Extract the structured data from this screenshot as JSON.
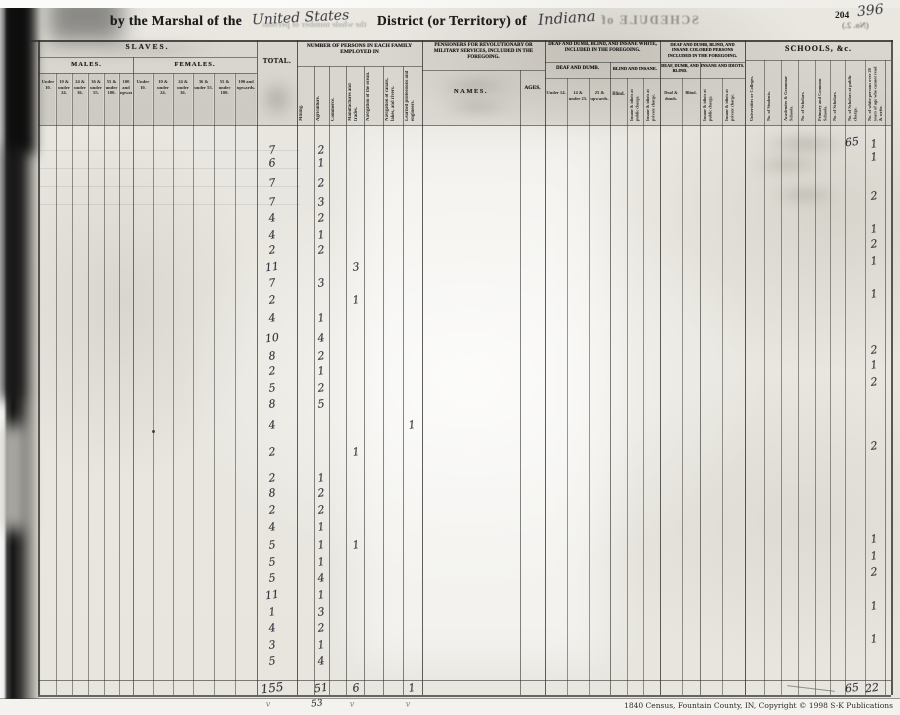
{
  "header": {
    "prefix": "by the Marshal of the",
    "written_jurisdiction": "United States",
    "district_label": "District (or Territory) of",
    "written_territory": "Indiana",
    "bleed_fragment": "the whole number of persons",
    "bleed_schedule": "SCHEDULE of",
    "page_number_printed": "204",
    "page_number_written": "396",
    "page_note_mirrored": "(No. 2.)"
  },
  "sections": {
    "slaves": {
      "title": "SLAVES.",
      "males": "MALES.",
      "females": "FEMALES.",
      "age_cols": [
        "Under 10.",
        "10 & under 24.",
        "24 & under 36.",
        "36 & under 55.",
        "55 & under 100.",
        "100 and upwards."
      ]
    },
    "total": {
      "title": "TOTAL."
    },
    "employment": {
      "title": "NUMBER OF PERSONS IN EACH FAMILY EMPLOYED IN",
      "cols": [
        "Mining.",
        "Agriculture.",
        "Commerce.",
        "Manufactures and trades.",
        "Navigation of the ocean.",
        "Navigation of canals, lakes, and rivers.",
        "Learned professions and engineers."
      ]
    },
    "pensioners": {
      "title": "PENSIONERS FOR REVOLUTIONARY OR MILITARY SERVICES, INCLUDED IN THE FOREGOING.",
      "names": "NAMES.",
      "ages": "AGES."
    },
    "white_disabled": {
      "title": "DEAF AND DUMB, BLIND, AND INSANE WHITE, INCLUDED IN THE FOREGOING.",
      "deaf_title": "DEAF AND DUMB.",
      "deaf_cols": [
        "Under 14.",
        "14 & under 25.",
        "25 & upwards."
      ],
      "blind_title": "BLIND AND INSANE.",
      "blind_cols": [
        "Blind.",
        "Insane & idiots at public charge.",
        "Insane & idiots at private charge."
      ]
    },
    "colored_disabled": {
      "title": "DEAF AND DUMB, BLIND, AND INSANE COLORED PERSONS INCLUDED IN THE FOREGOING.",
      "deaf_title": "DEAF, DUMB, AND BLIND.",
      "deaf_cols": [
        "Deaf & dumb.",
        "Blind."
      ],
      "insane_title": "INSANE AND IDIOTS.",
      "insane_cols": [
        "Insane & idiots at public charge.",
        "Insane & idiots at private charge."
      ]
    },
    "schools": {
      "title": "SCHOOLS, &c.",
      "cols": [
        "Universities or Colleges.",
        "No. of Students.",
        "Academies & Grammar Schools.",
        "No. of Scholars.",
        "Primary and Common Schools.",
        "No. of Scholars.",
        "No. of Scholars at public charge.",
        "No. of white persons over 20 years of age who cannot read & write."
      ]
    }
  },
  "records": {
    "rows": [
      {
        "n": 1,
        "total": "7",
        "agriculture": "2",
        "scholars": "65",
        "illiterate": "1"
      },
      {
        "n": 2,
        "total": "6",
        "agriculture": "1",
        "illiterate": "1"
      },
      {
        "n": 3,
        "total": "7",
        "agriculture": "2"
      },
      {
        "n": 4,
        "total": "7",
        "agriculture": "3",
        "illiterate": "2"
      },
      {
        "n": 5,
        "total": "4",
        "agriculture": "2"
      },
      {
        "n": 6,
        "total": "4",
        "agriculture": "1",
        "illiterate": "1"
      },
      {
        "n": 7,
        "total": "2",
        "agriculture": "2",
        "illiterate": "2"
      },
      {
        "n": 8,
        "total": "11",
        "manufactures": "3",
        "illiterate": "1"
      },
      {
        "n": 9,
        "total": "7",
        "agriculture": "3"
      },
      {
        "n": 10,
        "total": "2",
        "manufactures": "1",
        "illiterate": "1"
      },
      {
        "n": 11,
        "total": "4",
        "agriculture": "1"
      },
      {
        "n": 12,
        "total": "10",
        "agriculture": "4"
      },
      {
        "n": 13,
        "total": "8",
        "agriculture": "2",
        "illiterate": "2"
      },
      {
        "n": 14,
        "total": "2",
        "agriculture": "1",
        "illiterate": "1"
      },
      {
        "n": 15,
        "total": "5",
        "agriculture": "2",
        "illiterate": "2"
      },
      {
        "n": 16,
        "total": "8",
        "agriculture": "5"
      },
      {
        "n": 17,
        "total": "4",
        "learned_professions": "1"
      },
      {
        "n": 18,
        "total": "2",
        "manufactures": "1",
        "illiterate": "2"
      },
      {
        "n": 19,
        "total": "2",
        "agriculture": "1"
      },
      {
        "n": 20,
        "total": "8",
        "agriculture": "2"
      },
      {
        "n": 21,
        "total": "2",
        "agriculture": "2"
      },
      {
        "n": 22,
        "total": "4",
        "agriculture": "1"
      },
      {
        "n": 23,
        "total": "5",
        "agriculture": "1",
        "manufactures": "1",
        "illiterate": "1"
      },
      {
        "n": 24,
        "total": "5",
        "agriculture": "1",
        "illiterate": "1"
      },
      {
        "n": 25,
        "total": "5",
        "agriculture": "4",
        "illiterate": "2"
      },
      {
        "n": 26,
        "total": "11",
        "agriculture": "1"
      },
      {
        "n": 27,
        "total": "1",
        "agriculture": "3",
        "illiterate": "1"
      },
      {
        "n": 28,
        "total": "4",
        "agriculture": "2"
      },
      {
        "n": 29,
        "total": "3",
        "agriculture": "1",
        "illiterate": "1"
      },
      {
        "n": 30,
        "total": "5",
        "agriculture": "4"
      }
    ],
    "totals": {
      "total": "155",
      "agriculture": "51",
      "manufactures": "6",
      "learned_professions": "1",
      "scholars": "65",
      "illiterate": "22"
    },
    "pencil_marks": [
      {
        "col": "total",
        "v": "v"
      },
      {
        "col": "agriculture",
        "v": "53"
      },
      {
        "col": "manufactures",
        "v": "v"
      },
      {
        "col": "learned_professions",
        "v": "v"
      }
    ]
  },
  "footer": {
    "credit": "1840 Census, Fountain County, IN, Copyright © 1998 S-K Publications"
  }
}
